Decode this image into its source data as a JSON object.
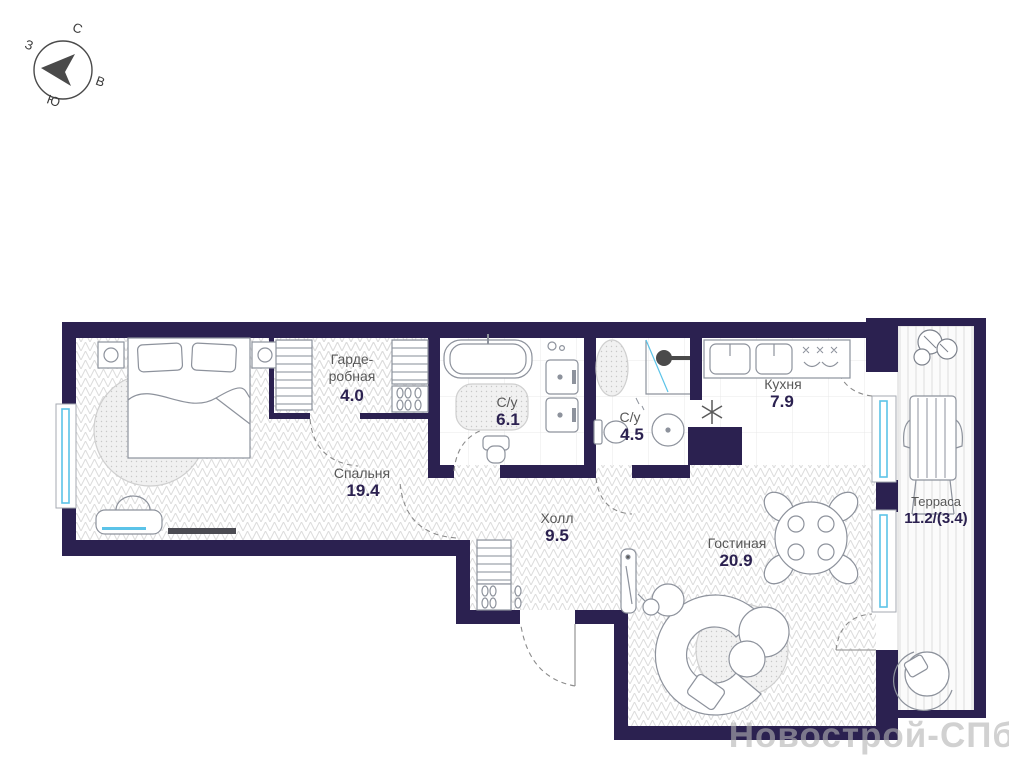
{
  "colors": {
    "wall": "#2b2150",
    "window": "#5bc3e8",
    "floor_line": "#dcdcdc",
    "label": "#585858",
    "area_number": "#2b2150",
    "furniture": "#8d929c",
    "watermark": "#b3b3b3"
  },
  "compass": {
    "north": "С",
    "east": "В",
    "south": "Ю",
    "west": "З"
  },
  "rooms": [
    {
      "key": "wardrobe",
      "name_line1": "Гарде-",
      "name_line2": "робная",
      "area": "4.0"
    },
    {
      "key": "bathroom-large",
      "name": "С/у",
      "area": "6.1"
    },
    {
      "key": "bathroom-small",
      "name": "С/у",
      "area": "4.5"
    },
    {
      "key": "kitchen",
      "name": "Кухня",
      "area": "7.9"
    },
    {
      "key": "bedroom",
      "name": "Спальня",
      "area": "19.4"
    },
    {
      "key": "hall",
      "name": "Холл",
      "area": "9.5"
    },
    {
      "key": "living-room",
      "name": "Гостиная",
      "area": "20.9"
    },
    {
      "key": "terrace",
      "name": "Терраса",
      "area": "11.2/(3.4)"
    }
  ],
  "watermark": "Новострой-СПб",
  "icons": {
    "compass_arrow": "northwest-triangle",
    "fridge": "snowflake",
    "shower": "shower-head",
    "plant": "monstera"
  }
}
